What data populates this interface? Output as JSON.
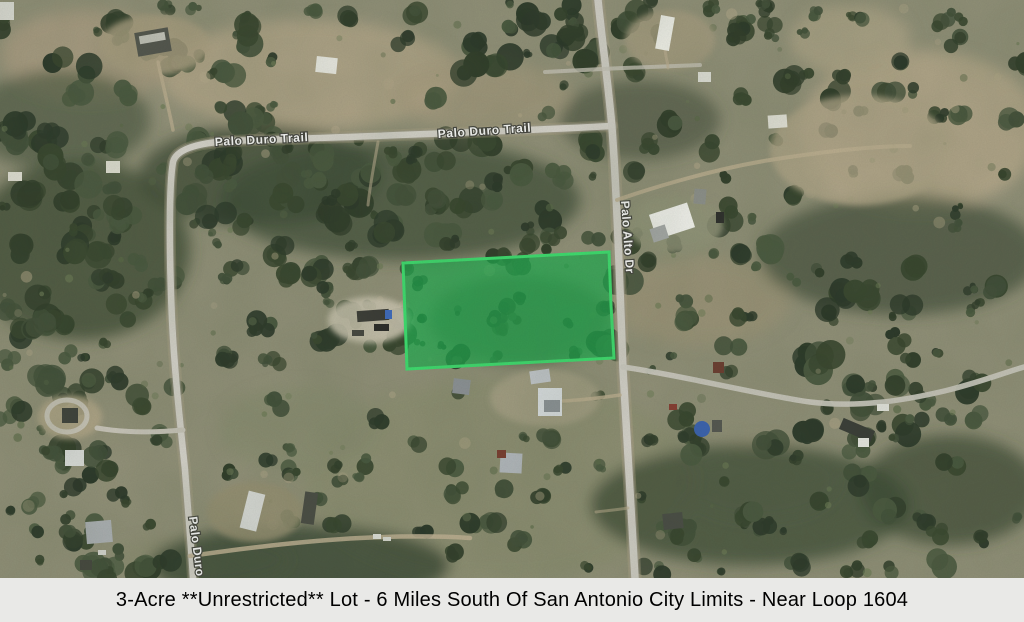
{
  "map": {
    "road_labels": {
      "palo_duro_trail_west": "Palo Duro Trail",
      "palo_duro_trail_east": "Palo Duro Trail",
      "palo_alto_dr": "Palo Alto Dr",
      "palo_duro": "Palo Duro"
    },
    "property_highlight": {
      "points": "403,263 609,252 611,305 614,358 500,364 407,369",
      "fill": "#1fae50",
      "fill_opacity": "0.72",
      "stroke": "#3ee070",
      "stroke_width": "3"
    },
    "terrain_colors": {
      "base": "#93927a",
      "open_field_tan": "#b3a68a",
      "tree_canopy_dark": "#38462f",
      "road_gray": "#d8d5cd"
    }
  },
  "caption": {
    "text": "3-Acre **Unrestricted** Lot - 6 Miles South Of San Antonio City Limits - Near Loop 1604",
    "background": "#e9e9e7",
    "color": "#000000"
  }
}
